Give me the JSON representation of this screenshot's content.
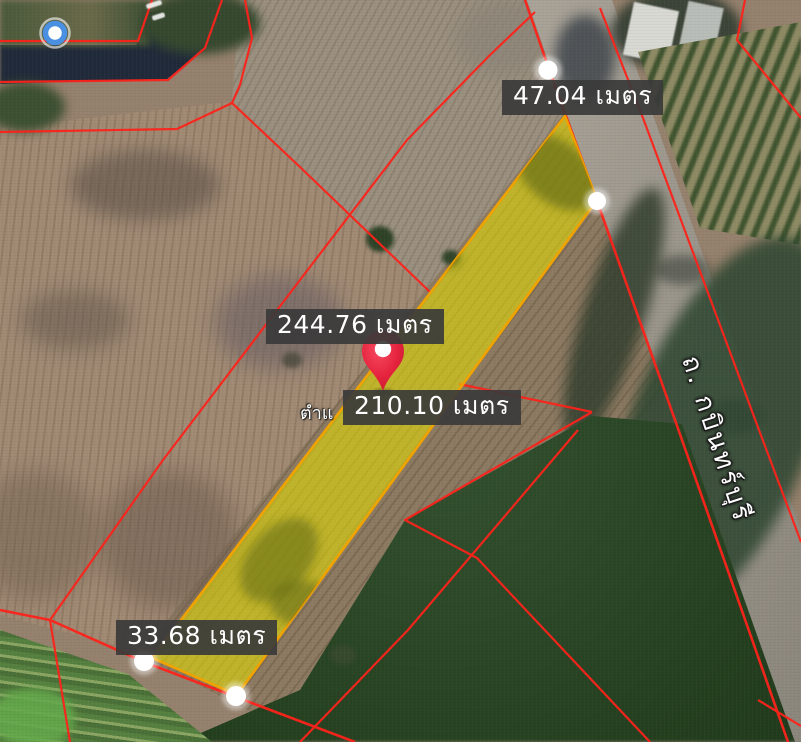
{
  "map": {
    "parcel_side_labels": {
      "top": "47.04 เมตร",
      "left": "244.76 เมตร",
      "right": "210.10 เมตร",
      "bottom": "33.68 เมตร"
    },
    "partial_text": "ตำแ",
    "road_name": "ถ. กบินทร์บุรี",
    "colors": {
      "parcel_fill": "#eae100",
      "parcel_border": "#f0a300",
      "boundary_red": "#fb231b",
      "label_background": "#3a3a3a",
      "label_text": "#ffffff",
      "pin_red": "#e6243e",
      "location_ring_blue": "#4a90e2"
    },
    "icons": {
      "pin": "map-pin-icon",
      "vertex_marker": "white-dot-marker-icon",
      "current_location": "blue-location-dot-icon"
    }
  }
}
